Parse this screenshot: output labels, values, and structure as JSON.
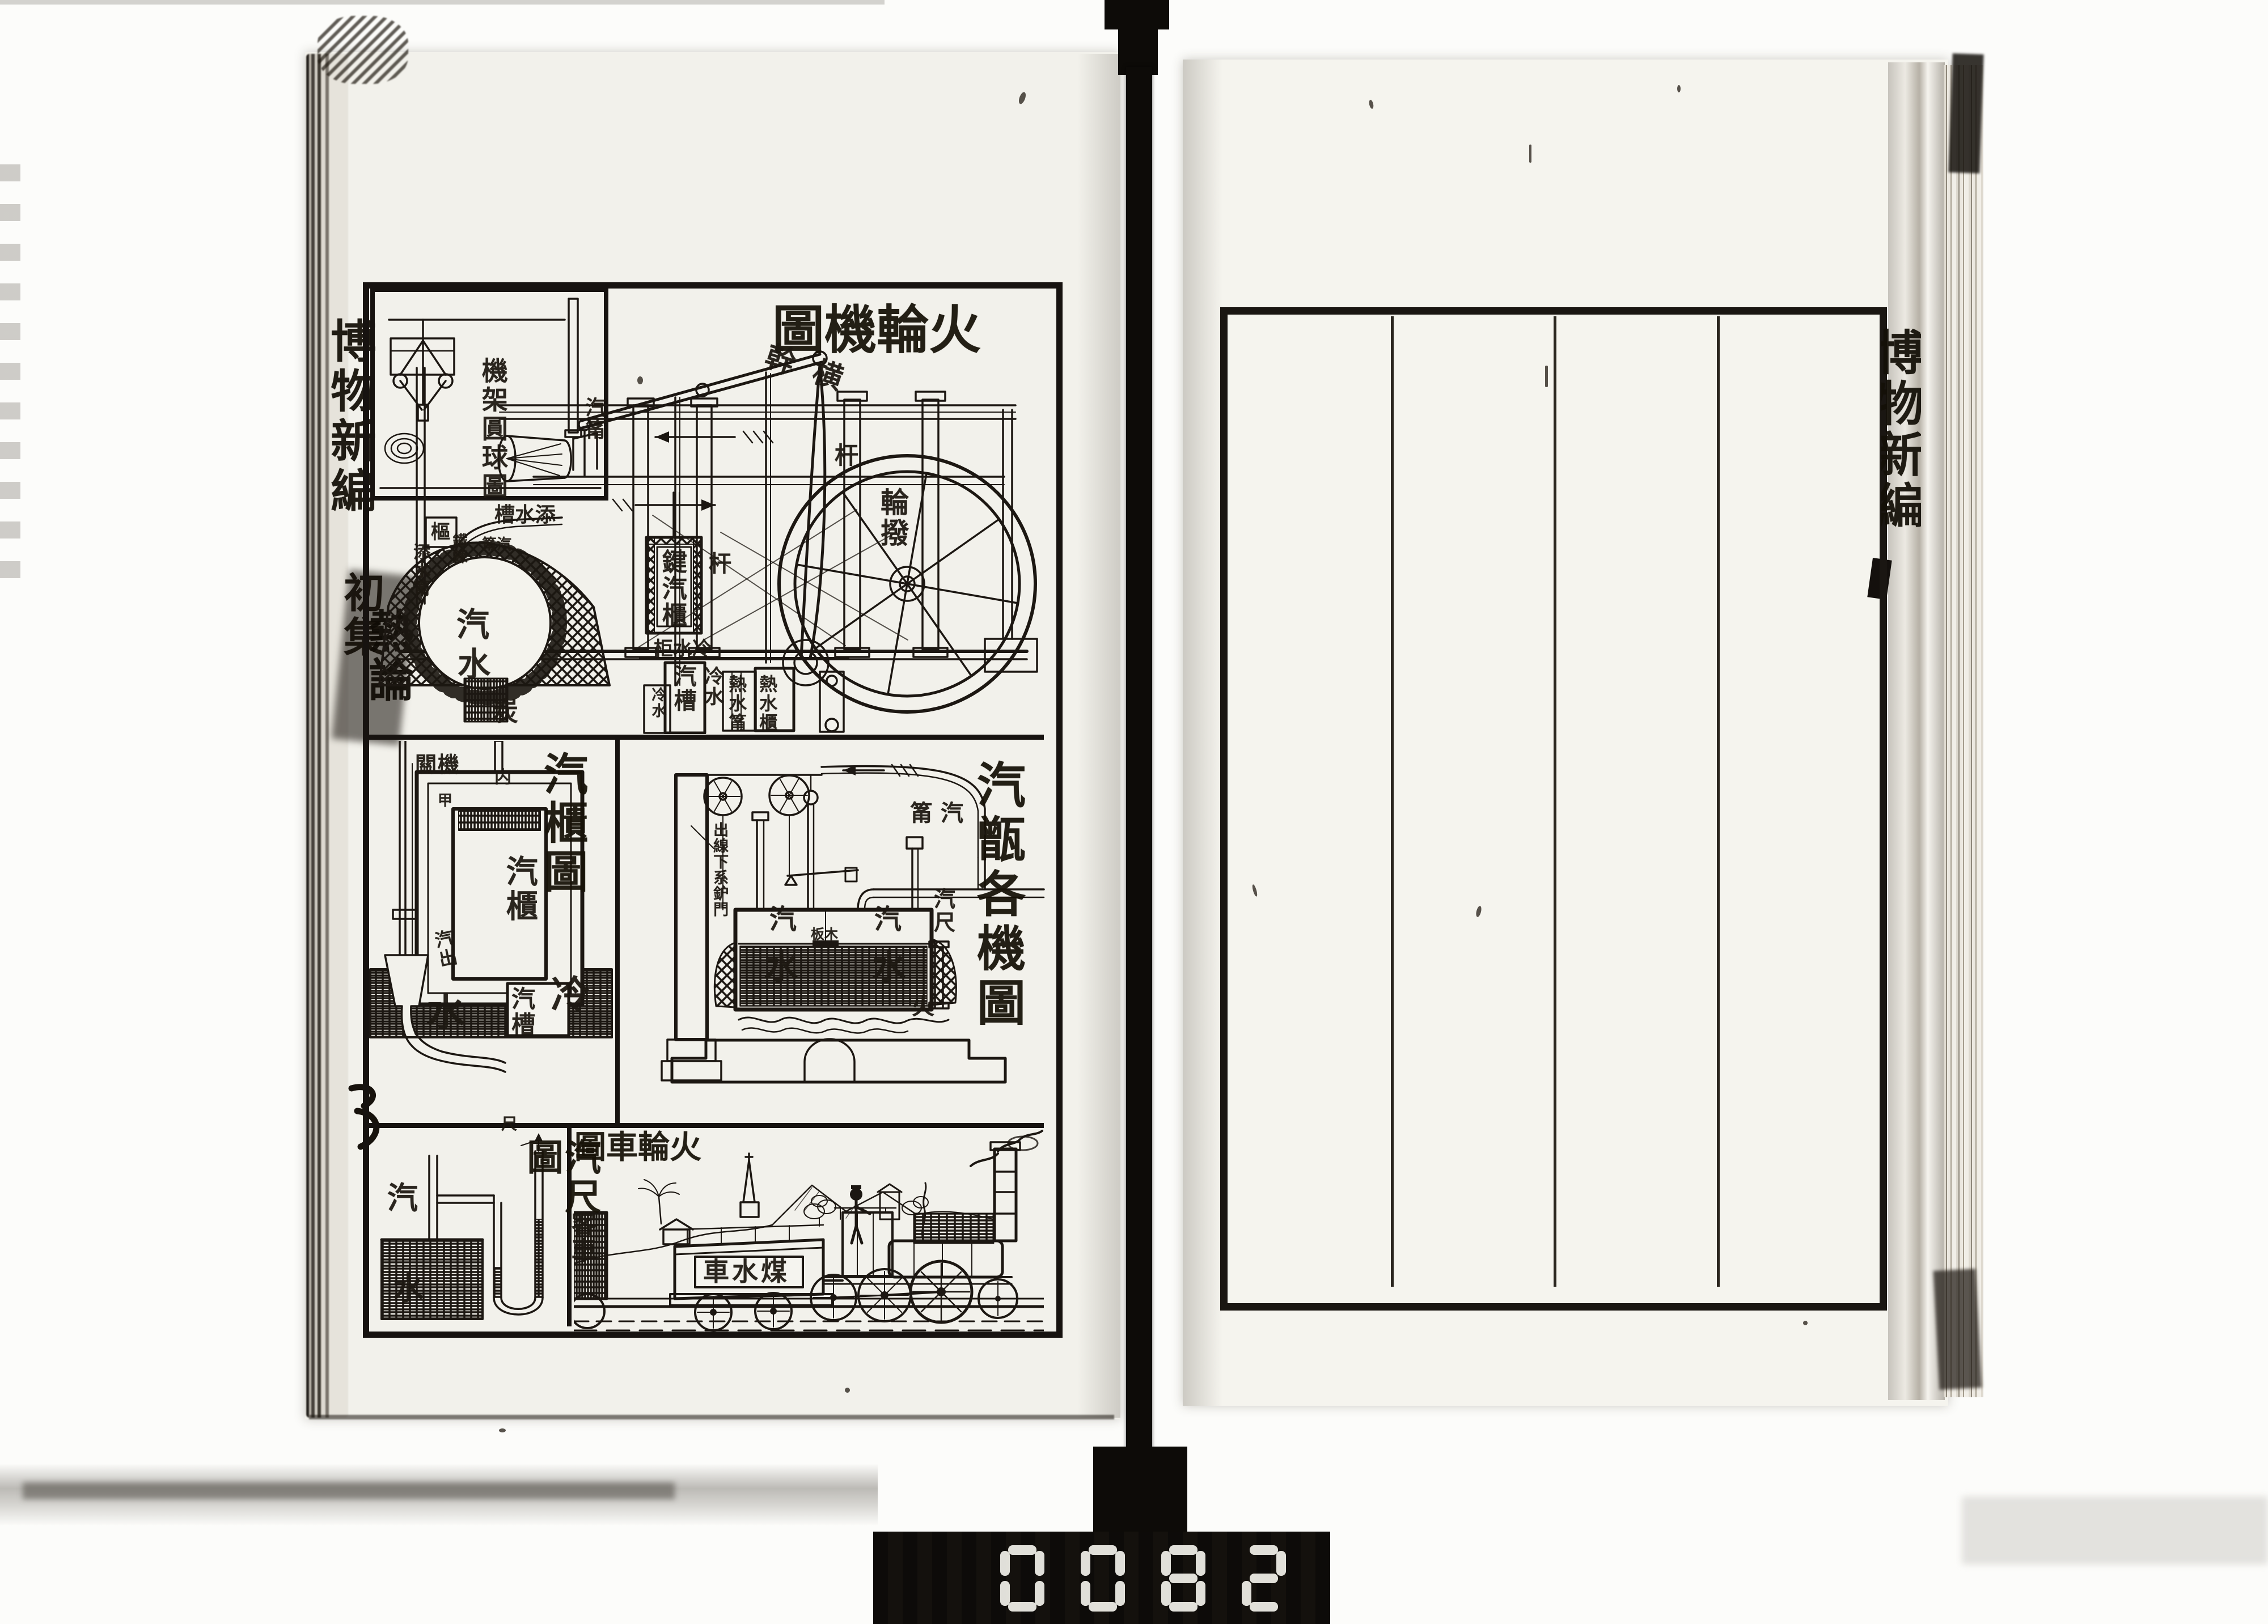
{
  "book": {
    "left_margin": {
      "series": "博物新編",
      "volume": "初集",
      "chapter": "熱論"
    },
    "right_margin": {
      "series": "博物新編"
    }
  },
  "plate": {
    "engine": {
      "title": "火輪機圖",
      "inset_caption": "機架圓球圖",
      "inset_steam_pipe": "汽筩",
      "beam": "横幹",
      "rod_a": "杆",
      "rod_b": "杆",
      "crank": "輪撥",
      "feed_trough": "添水槽",
      "feed_pipe": "添水筩",
      "pivot": "樞",
      "chain": "鐵鍊",
      "steam_pipe": "汽筩",
      "boiler_steam": "汽",
      "boiler_water": "水",
      "coal": "炭",
      "valve_chest": "鍵汽櫃",
      "cold_water_box": "冷水柜",
      "steam_trough": "汽槽",
      "cold_water_small": "冷水",
      "cold_water": "冷水",
      "hot_water_pipe": "熱水筩",
      "hot_water_tank": "熱水櫃"
    },
    "valve": {
      "title": "汽櫃圖",
      "gear": "機關",
      "rod": "内",
      "marker": "甲",
      "steam_chest": "汽櫃",
      "steam_out": "汽出",
      "steam_trough": "汽槽",
      "cold": "冷",
      "water": "水"
    },
    "boiler": {
      "title": "汽甑各機圖",
      "steam_pipe": "汽筩",
      "furnace_door_line": "出線下系鈩門",
      "steam_left": "汽",
      "steam_right": "汽",
      "float_board": "木板",
      "gauge": "汽尺",
      "water_left": "水",
      "water_right": "水",
      "fire": "火"
    },
    "gauge": {
      "title": "汽尺圖",
      "ruler": "尺",
      "steam": "汽",
      "water": "水"
    },
    "locomotive": {
      "title": "火輪車圖",
      "passenger_car": "客車",
      "tender": "煤水車"
    }
  },
  "right_page": {
    "ruled_columns": 4
  },
  "counter": {
    "digits": "0082"
  }
}
